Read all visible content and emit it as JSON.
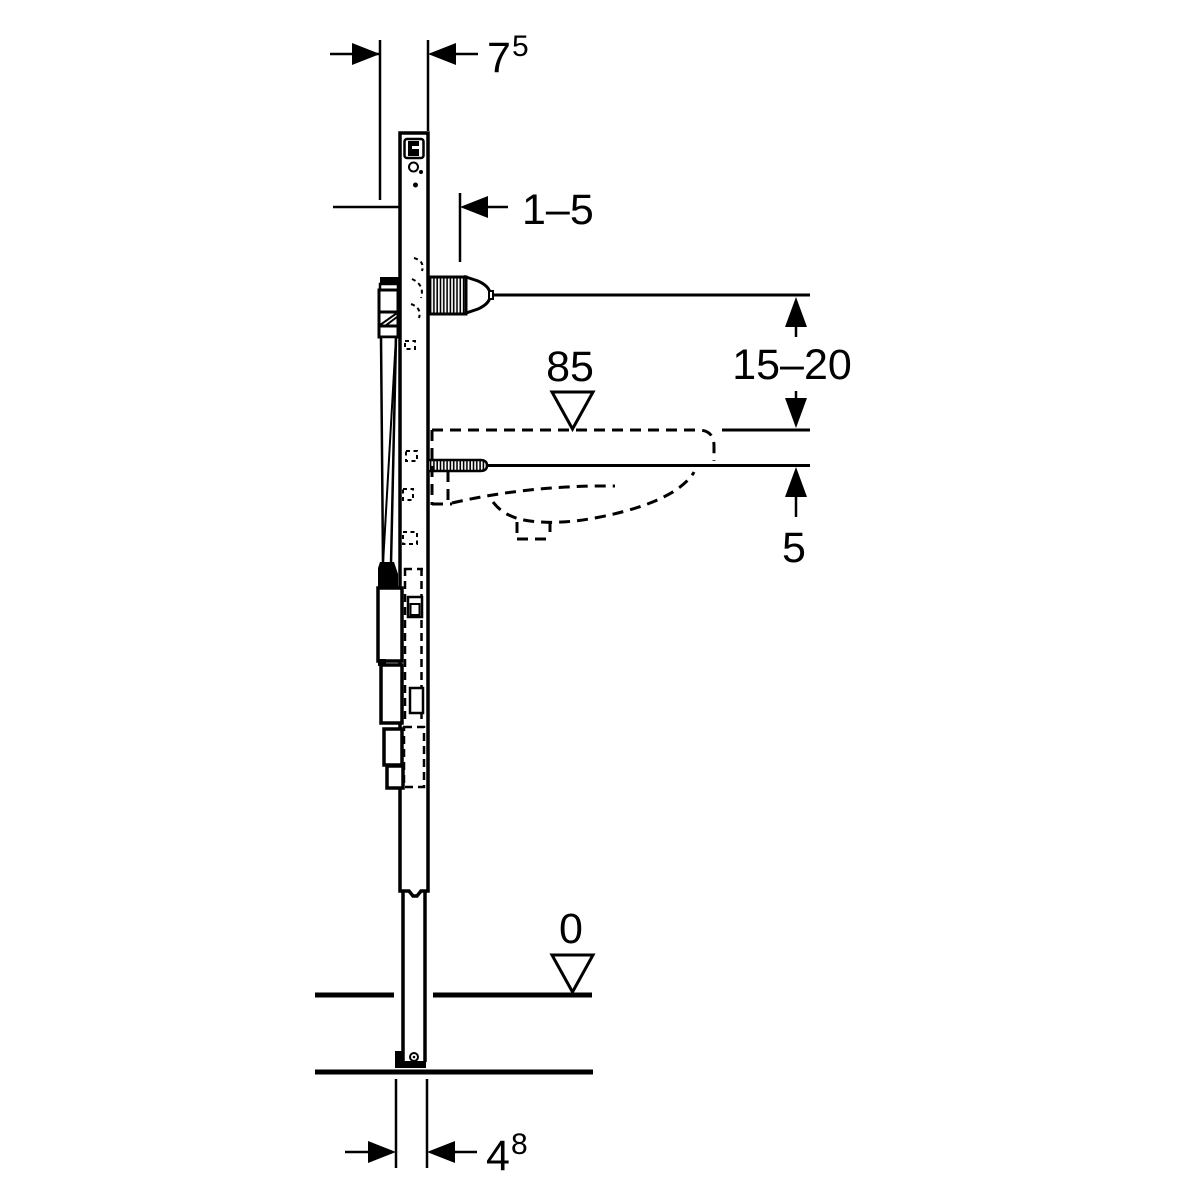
{
  "colors": {
    "background": "#ffffff",
    "line": "#000000"
  },
  "labels": {
    "frame_depth_main": "7",
    "frame_depth_sup": "5",
    "wall_lining_range": "1–5",
    "basin_rim_height": "85",
    "connection_above_rim": "15–20",
    "rod_below_rim": "5",
    "floor_level": "0",
    "foot_width_main": "4",
    "foot_width_sup": "8"
  }
}
